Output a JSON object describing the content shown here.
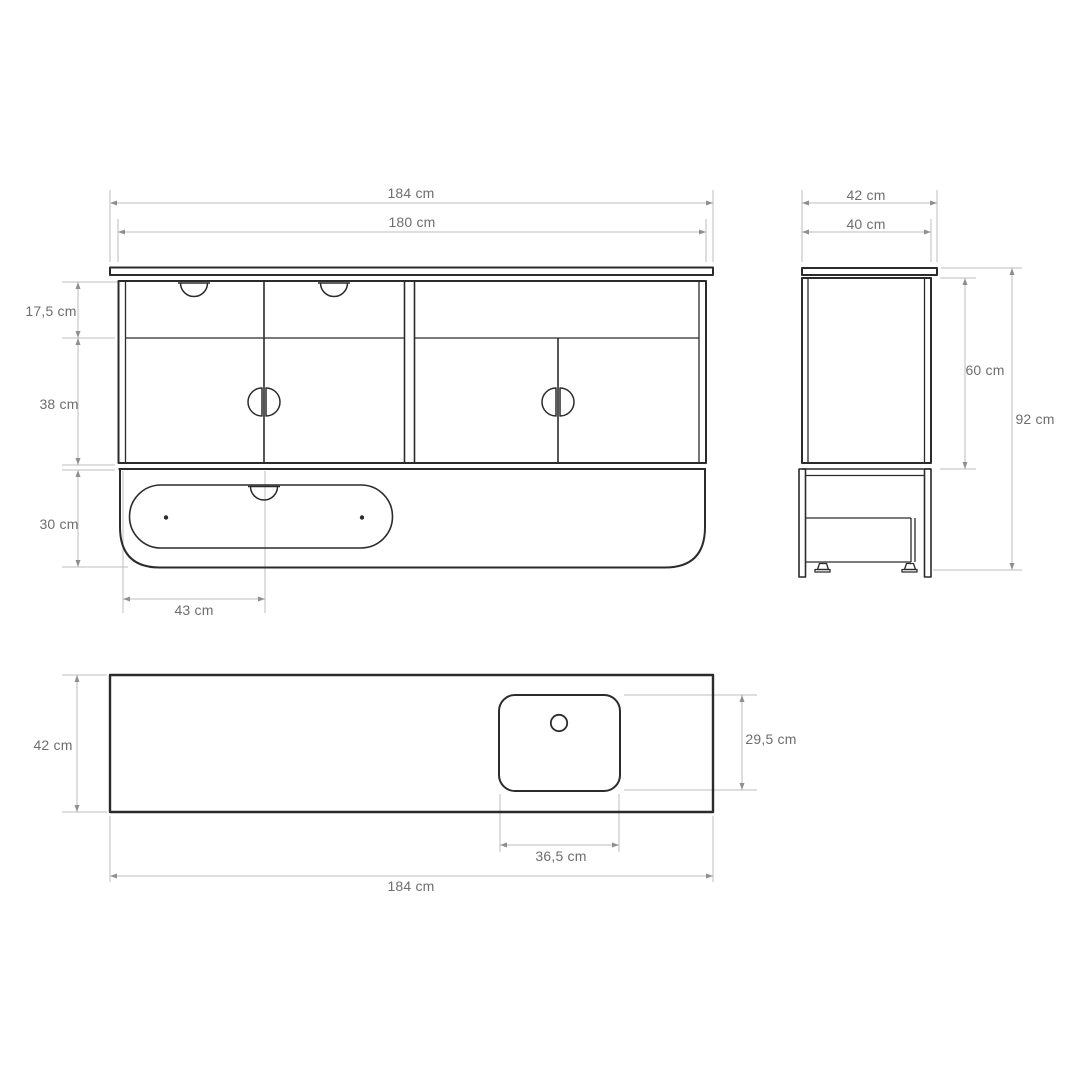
{
  "drawing": {
    "type": "furniture-technical-drawing",
    "units": "cm",
    "colors": {
      "line": "#2b2b2b",
      "dimension_line": "#bdbdbd",
      "arrow": "#8f8f8f",
      "label_text": "#6e6e6e",
      "background": "#ffffff"
    },
    "views": {
      "front": {
        "dims": {
          "width_total": "184 cm",
          "width_body": "180 cm",
          "drawer_row_height": "17,5 cm",
          "door_row_height": "38 cm",
          "base_height": "30 cm",
          "drawer_width": "43 cm"
        }
      },
      "side": {
        "dims": {
          "depth_total": "42 cm",
          "depth_body": "40 cm",
          "carcass_height": "60 cm",
          "total_height": "92 cm"
        }
      },
      "top": {
        "dims": {
          "depth": "42 cm",
          "sink_depth": "29,5 cm",
          "sink_width": "36,5 cm",
          "width_total": "184 cm"
        }
      }
    }
  }
}
